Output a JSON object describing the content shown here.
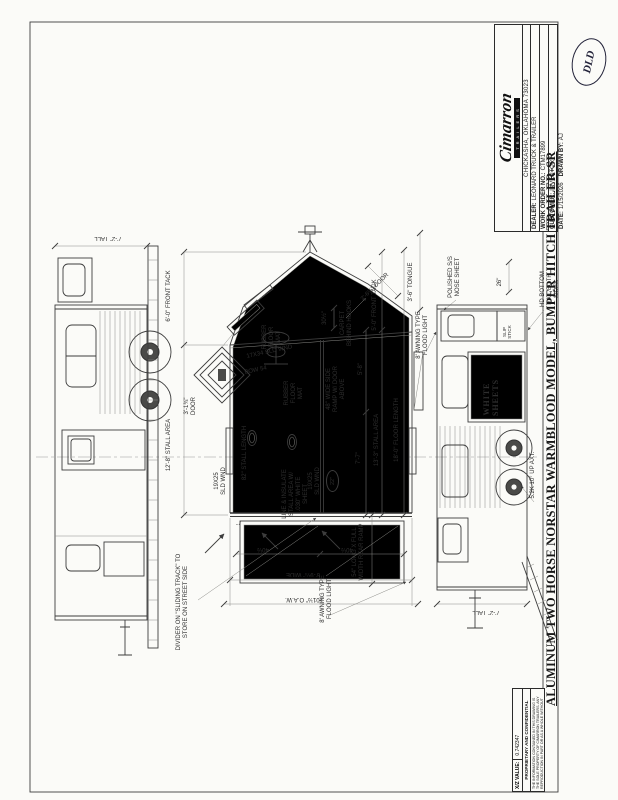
{
  "title_block": {
    "logo_text": "Cimarron",
    "logo_sub": "TRAILERS",
    "address": "CHICKASHA, OKLAHOMA 73023",
    "dealer_label": "DEALER:",
    "dealer": "LEONARD TRUCK & TRAILER",
    "work_order_label": "WORK ORDER NO.:",
    "work_order": "CTM17899",
    "customer_label": "CUSTOMER:",
    "customer": "INVENTORY",
    "date_label": "DATE:",
    "date": "1/15/2026",
    "drawn_by_label": "DRAWN BY:",
    "drawn_by": "AJ",
    "approval_mark": "DLD"
  },
  "sheet": {
    "main_title": "ALUMINUM TWO HORSE NORSTAR WARMBLOOD MODEL, BUMPER HITCH TRAILER-SR",
    "xz_label": "X/Z VALUE:",
    "xz_value": "0.742347",
    "proprietary_title": "PROPRIETARY AND CONFIDENTIAL",
    "proprietary_text": "THE INFORMATION CONTAINED IN THIS DRAWING IS THE SOLE PROPERTY OF CIMARRON TRAILERS. ANY REPRODUCTION IN PART OR AS A WHOLE WITHOUT THE WRITTEN PERMISSION OF CIMARRON TRAILERS IS PROHIBITED."
  },
  "views": {
    "street": {
      "tall": "7'-2\" TALL"
    },
    "curb": {
      "tall": "7'-2\" TALL",
      "polished_nose": "POLISHED S/S NOSE SHEET",
      "white_sheets": "WHITE SHEETS",
      "hd_bottom_rail": "HD BOTTOM RAIL BOTH SIDES",
      "axles": "5.2K 10° UP AXT.",
      "dim_26": "26\"",
      "slip_stick": "SLIP STICK",
      "flood_light": "8' AWNING TYPE FLOOD LIGHT"
    },
    "plan": {
      "front_tack_left": "6'-0\" FRONT TACK",
      "stall_area_left": "12'-8\" STALL AREA",
      "tongue": "3'-6\" TONGUE",
      "front_tack_right": "5'-0\" FRONT TACK",
      "dim_5_8": "5'-8\"",
      "stall_area_right": "13'-3\" STALL AREA",
      "floor_length": "18'-0\" FLOOR LENGTH",
      "dim_7_7": "7'-7\"",
      "rear_ramp": "54\" LONG X FULL WIDTH REAR RAMP",
      "flood_light": "8' AWNING TYPE FLOOD LIGHT",
      "rubber_mat_1": "RUBBER FLOOR MAT",
      "rubber_mat_2": "RUBBER FLOOR MAT",
      "carpet_hooks": "CARPET BEHIND HOOKS",
      "nose_door": "2'-6½\" DOOR",
      "dim_30": "30½\"",
      "sld_wnd_17": "17X34 SLD WND",
      "bow": "BOW 54",
      "escape_door": "3'-1¾\" DOOR",
      "side_ramp": "48\" WIDE SIDE RAMP W/ DOOR ABOVE",
      "sld_wnd_19_left": "19X25 SLD WND",
      "sld_wnd_19_right": "19X25 SLD WND",
      "stall_length": "82\" STALL LENGTH",
      "line_insulate": "LINE & INSULATE STALL AREA W/ .030\" WHITE SHEET",
      "dim_22": "22\"",
      "dim_7": "7\"",
      "dim_40_a": "40½",
      "dim_40_b": "40½",
      "width": "6'-9¼\" WIDE",
      "oaw": "101½\" O.A.W.",
      "divider_note": "DIVIDER ON \"SLIDING TRACK\" TO STORE ON STREET SIDE"
    }
  }
}
